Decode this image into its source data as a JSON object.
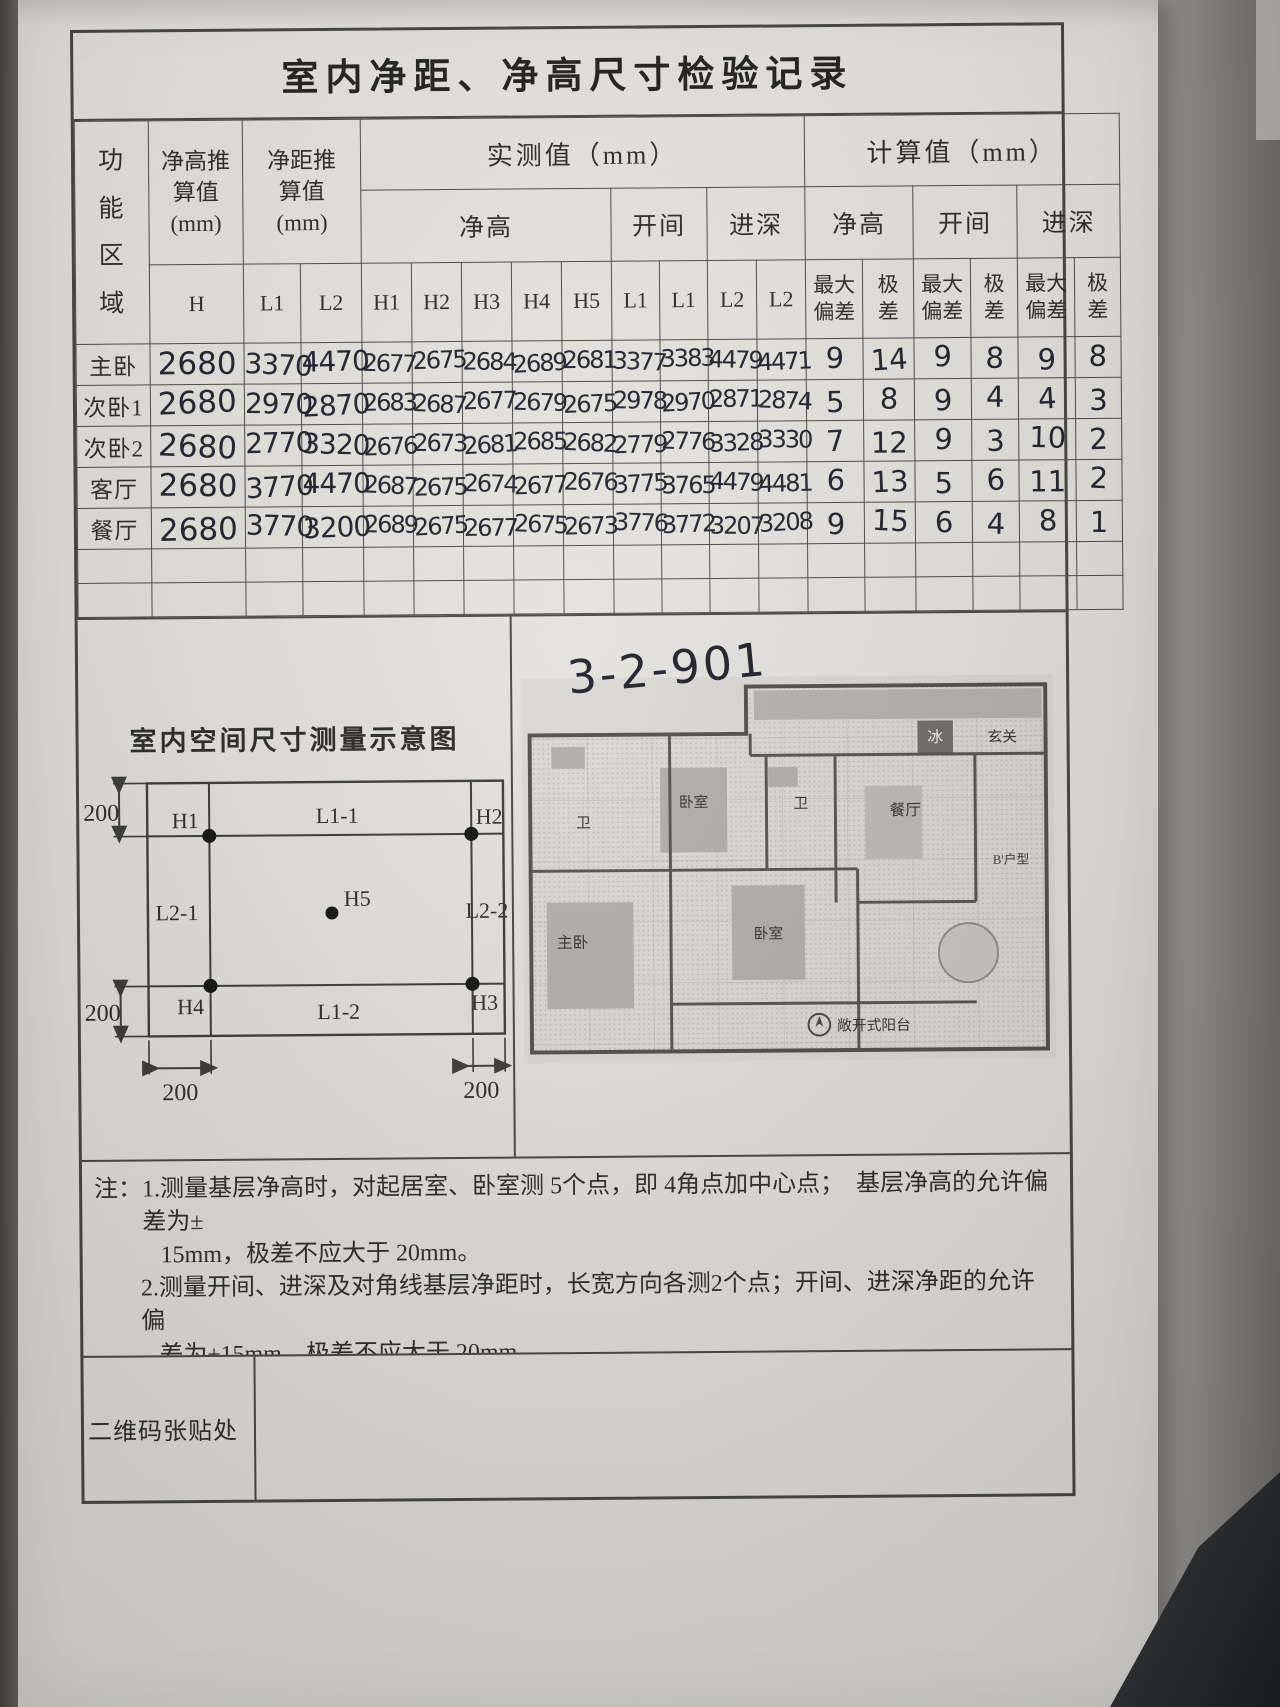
{
  "colors": {
    "paper": "#e7e5e0",
    "ink": "#22222e",
    "line": "#46453f"
  },
  "title": "室内净距、净高尺寸检验记录",
  "table": {
    "area_header": "功\n能\n区\n域",
    "height_est_header": "净高推\n算值\n(mm)",
    "dist_est_header": "净距推\n算值\n(mm)",
    "measured_header": "实测值（mm）",
    "computed_header": "计算值（mm）",
    "sub_headers": {
      "height": "净高",
      "bay": "开间",
      "depth": "进深"
    },
    "computed_sub": {
      "max_dev": "最大\n偏差",
      "range": "极\n差"
    },
    "col_labels": [
      "H",
      "L1",
      "L2",
      "H1",
      "H2",
      "H3",
      "H4",
      "H5",
      "L1",
      "L1",
      "L2",
      "L2"
    ],
    "rows": [
      {
        "area": "主卧",
        "h": "2680",
        "l1": "3370",
        "l2": "4470",
        "vals": [
          "2677",
          "2675",
          "2684",
          "2689",
          "2681",
          "3377",
          "3383",
          "4479",
          "4471"
        ],
        "calc": [
          "9",
          "14",
          "9",
          "8",
          "9",
          "8"
        ]
      },
      {
        "area": "次卧1",
        "h": "2680",
        "l1": "2970",
        "l2": "2870",
        "vals": [
          "2683",
          "2687",
          "2677",
          "2679",
          "2675",
          "2978",
          "2970",
          "2871",
          "2874"
        ],
        "calc": [
          "5",
          "8",
          "9",
          "4",
          "4",
          "3"
        ]
      },
      {
        "area": "次卧2",
        "h": "2680",
        "l1": "2770",
        "l2": "3320",
        "vals": [
          "2676",
          "2673",
          "2681",
          "2685",
          "2682",
          "2779",
          "2776",
          "3328",
          "3330"
        ],
        "calc": [
          "7",
          "12",
          "9",
          "3",
          "10",
          "2"
        ]
      },
      {
        "area": "客厅",
        "h": "2680",
        "l1": "3770",
        "l2": "4470",
        "vals": [
          "2687",
          "2675",
          "2674",
          "2677",
          "2676",
          "3775",
          "3765",
          "4479",
          "4481"
        ],
        "calc": [
          "6",
          "13",
          "5",
          "6",
          "11",
          "2"
        ]
      },
      {
        "area": "餐厅",
        "h": "2680",
        "l1": "3770",
        "l2": "3200",
        "vals": [
          "2689",
          "2675",
          "2677",
          "2675",
          "2673",
          "3776",
          "3772",
          "3207",
          "3208"
        ],
        "calc": [
          "9",
          "15",
          "6",
          "4",
          "8",
          "1"
        ]
      }
    ],
    "empty_rows": 2
  },
  "diagram": {
    "title": "室内空间尺寸测量示意图",
    "points": {
      "h1": "H1",
      "h2": "H2",
      "h3": "H3",
      "h4": "H4",
      "h5": "H5"
    },
    "edges": {
      "top": "L1-1",
      "bottom": "L1-2",
      "left": "L2-1",
      "right": "L2-2"
    },
    "offset": "200"
  },
  "floorplan": {
    "unit_code": "3-2-901",
    "rooms": {
      "fridge": "冰",
      "foyer": "玄关",
      "bath1": "卫",
      "bed1": "卧室",
      "bath2": "卫",
      "dining": "餐厅",
      "unit_type": "B'户型",
      "master": "主卧",
      "bed2": "卧室",
      "balcony": "敞开式阳台"
    }
  },
  "notes": {
    "prefix": "注：",
    "items": [
      "1.测量基层净高时，对起居室、卧室测 5个点，即 4角点加中心点；  基层净高的允许偏差为±\n   15mm，极差不应大于 20mm。",
      "2.测量开间、进深及对角线基层净距时，长宽方向各测2个点；开间、进深净距的允许偏\n   差为±15mm，极差不应大于 20mm。",
      "3.偏差为实测值与标准值之间的绝对差；极差为实测中最大值与最小值之差，不合格点\n   数在表内用红笔圈出。"
    ]
  },
  "qr_label": "二维码张贴处"
}
